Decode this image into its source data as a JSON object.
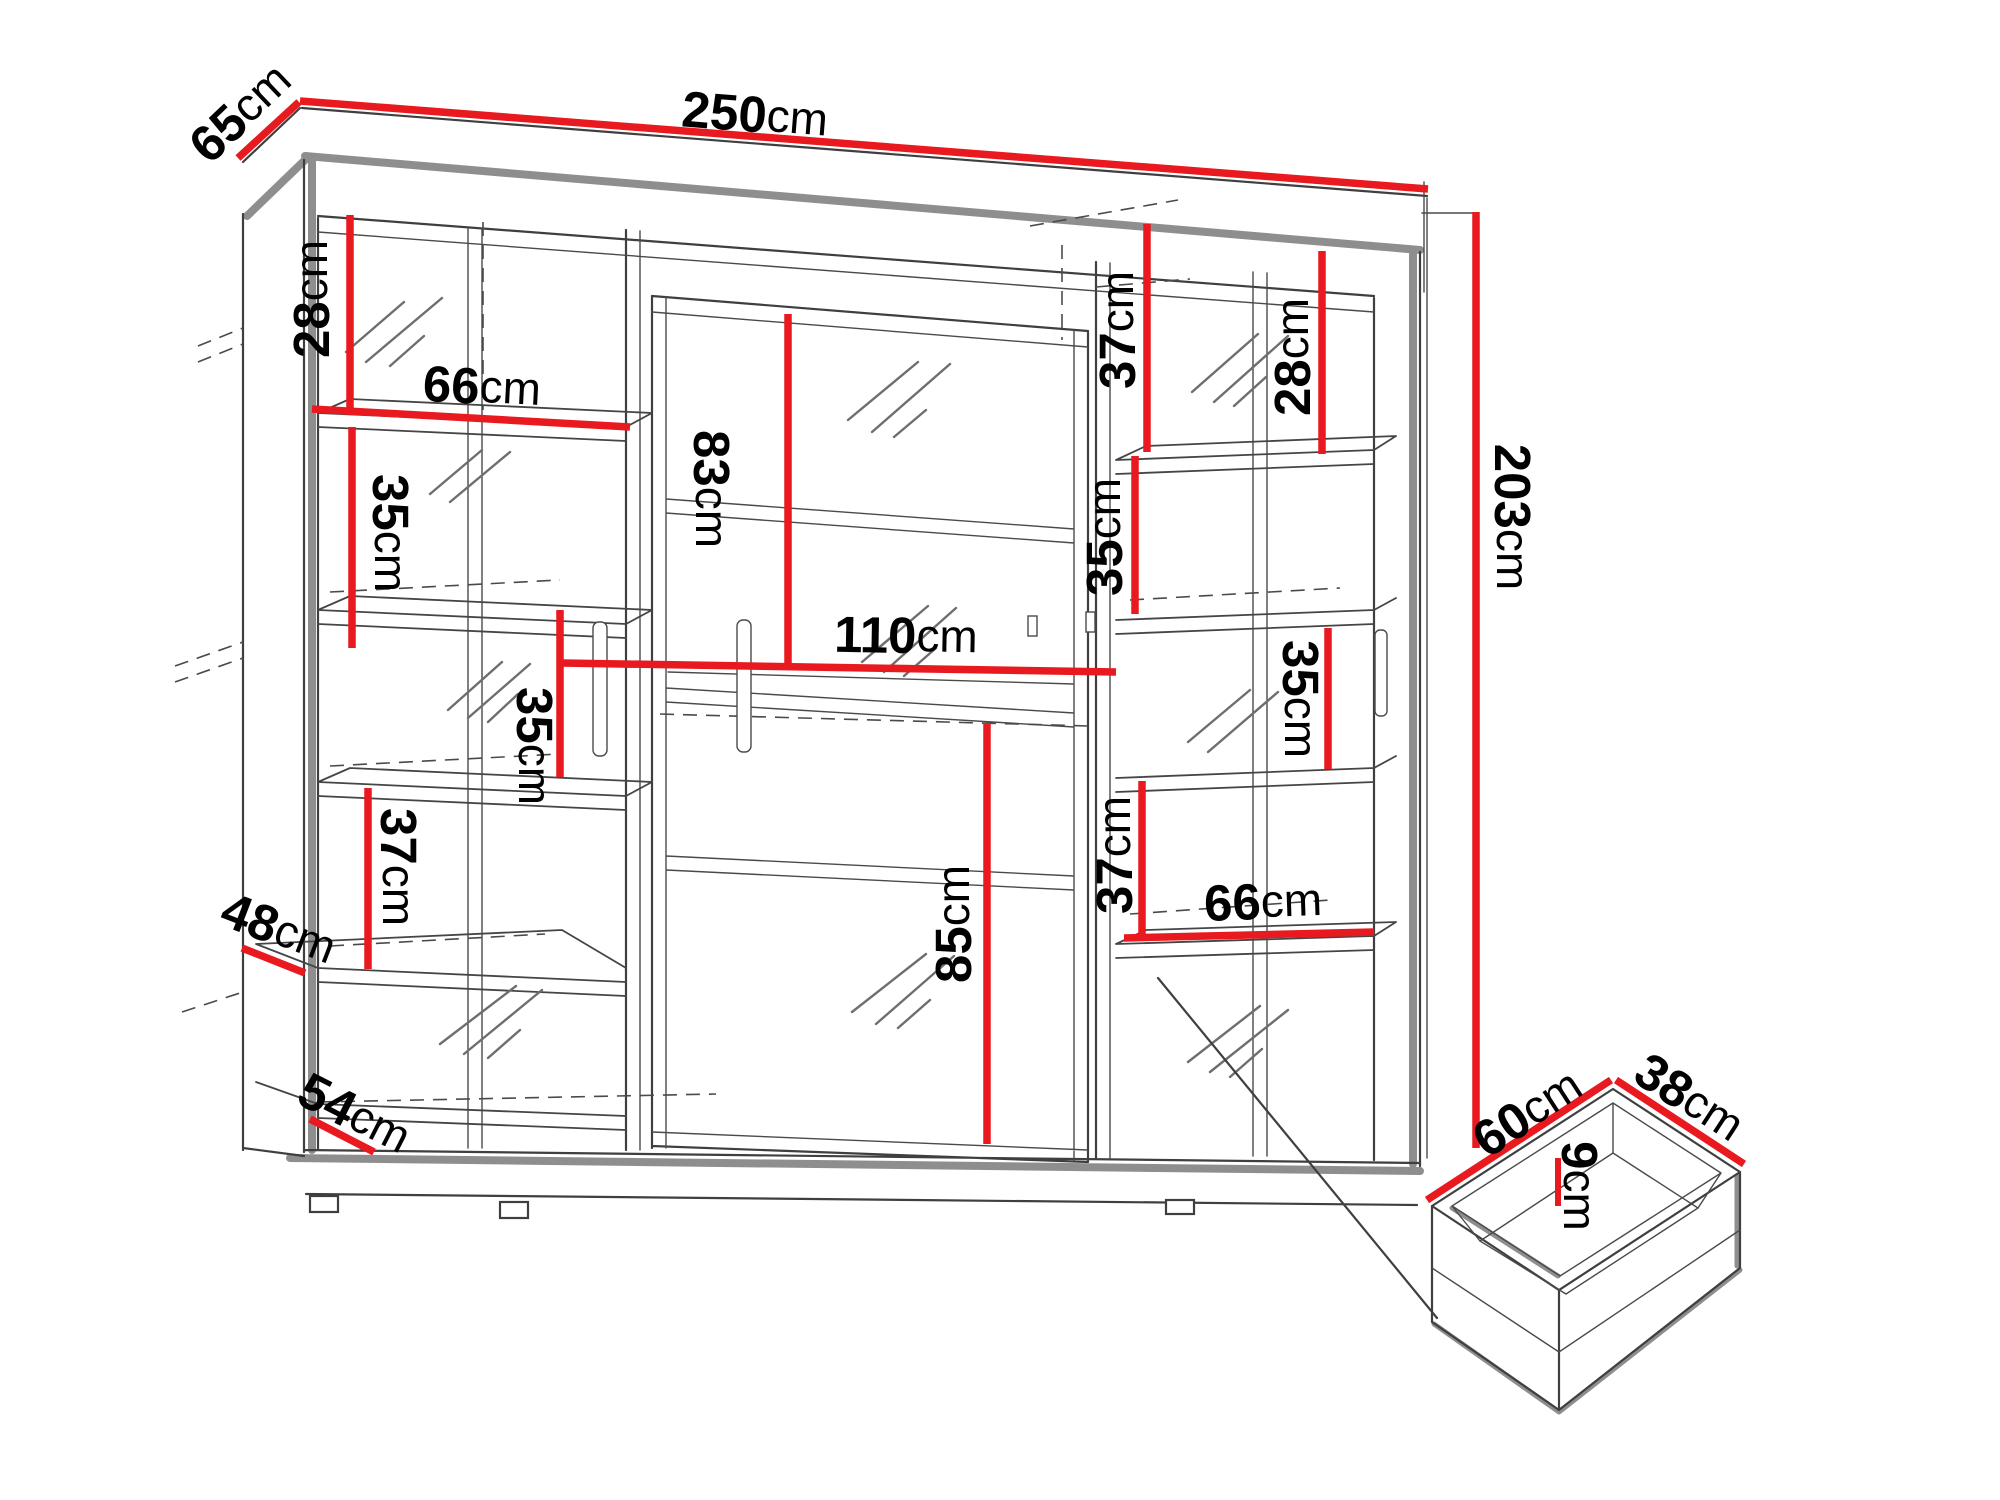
{
  "diagram": {
    "kind": "furniture-dimension-diagram",
    "subject": "sliding-door wardrobe with interior shelving and pull-out drawer detail",
    "unit": "cm",
    "accent_color": "#e8191f",
    "line_color": "#3f3f3f",
    "shadow_color": "#8e8e8e",
    "background_color": "#ffffff",
    "text_color": "#000000"
  },
  "wardrobe": {
    "overall_width": "250",
    "overall_depth": "65",
    "overall_height": "203"
  },
  "drawer": {
    "depth": "60",
    "width": "38",
    "height": "9"
  },
  "labels": [
    {
      "value": "250",
      "unit": "cm",
      "measure": "overall-width"
    },
    {
      "value": "65",
      "unit": "cm",
      "measure": "overall-depth"
    },
    {
      "value": "203",
      "unit": "cm",
      "measure": "overall-height"
    },
    {
      "value": "28",
      "unit": "cm",
      "measure": "left-top-section-height"
    },
    {
      "value": "66",
      "unit": "cm",
      "measure": "left-shelf-width"
    },
    {
      "value": "35",
      "unit": "cm",
      "measure": "left-upper-section-height"
    },
    {
      "value": "35",
      "unit": "cm",
      "measure": "left-middle-section-height"
    },
    {
      "value": "37",
      "unit": "cm",
      "measure": "left-lower-section-height"
    },
    {
      "value": "48",
      "unit": "cm",
      "measure": "left-shelf-depth"
    },
    {
      "value": "54",
      "unit": "cm",
      "measure": "base-shelf-depth"
    },
    {
      "value": "83",
      "unit": "cm",
      "measure": "center-top-section-height"
    },
    {
      "value": "110",
      "unit": "cm",
      "measure": "center-section-width"
    },
    {
      "value": "85",
      "unit": "cm",
      "measure": "center-bottom-section-height"
    },
    {
      "value": "37",
      "unit": "cm",
      "measure": "center-right-top-section-height"
    },
    {
      "value": "28",
      "unit": "cm",
      "measure": "right-top-section-height"
    },
    {
      "value": "35",
      "unit": "cm",
      "measure": "center-right-mid-section-height"
    },
    {
      "value": "35",
      "unit": "cm",
      "measure": "right-mid-section-height"
    },
    {
      "value": "37",
      "unit": "cm",
      "measure": "right-lower-section-height"
    },
    {
      "value": "66",
      "unit": "cm",
      "measure": "right-shelf-width"
    },
    {
      "value": "60",
      "unit": "cm",
      "measure": "drawer-depth"
    },
    {
      "value": "38",
      "unit": "cm",
      "measure": "drawer-width"
    },
    {
      "value": "9",
      "unit": "cm",
      "measure": "drawer-height"
    }
  ]
}
